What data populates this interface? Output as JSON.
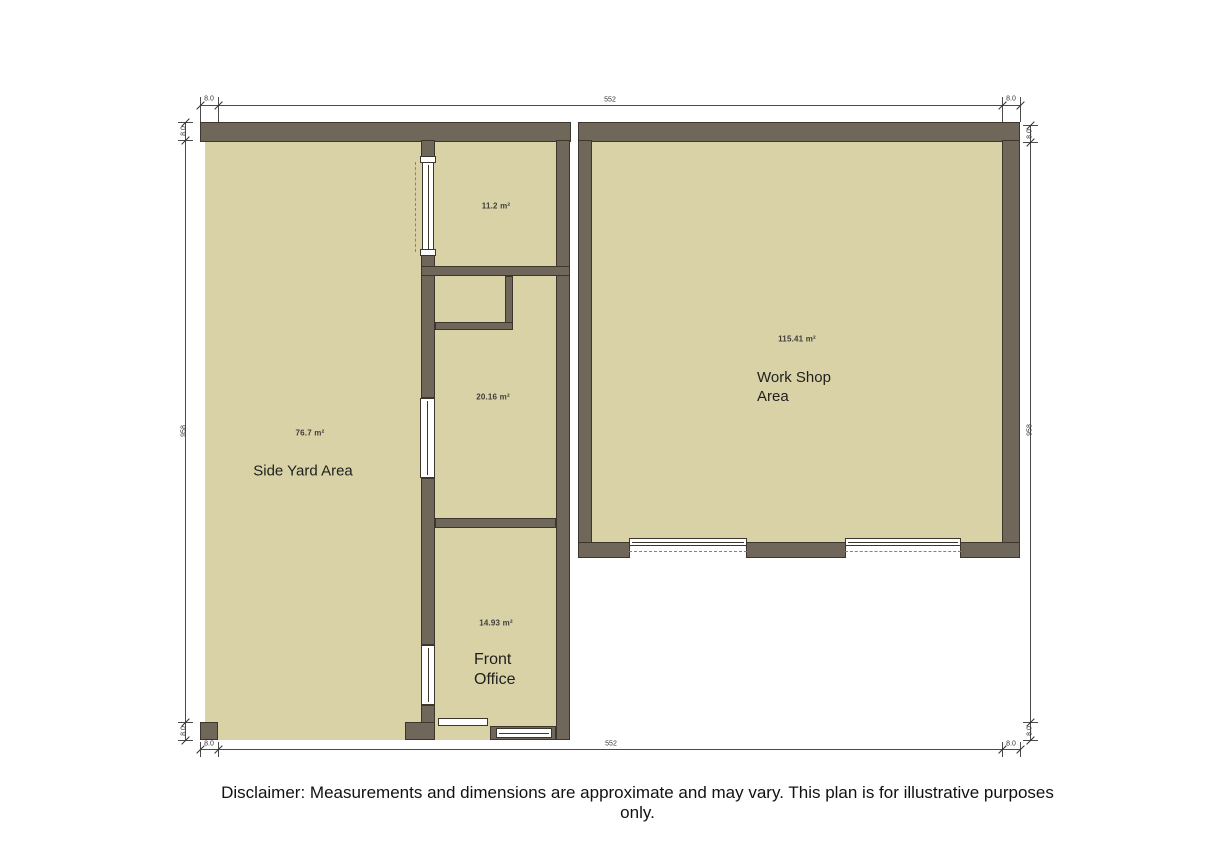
{
  "colors": {
    "background": "#ffffff",
    "floor": "#d8d2a6",
    "wall": "#6f6759",
    "wall_outline": "#3c362c",
    "dim_line": "#4a4a4a",
    "label": "#3d3d3d",
    "room_text": "#1f1f1f"
  },
  "rooms": {
    "side_yard": {
      "name": "Side Yard Area",
      "area": "76.7 m²"
    },
    "workshop": {
      "name_line1": "Work Shop",
      "name_line2": "Area",
      "area": "115.41 m²"
    },
    "front_office": {
      "name_line1": "Front",
      "name_line2": "Office",
      "area": "14.93 m²"
    },
    "store_top": {
      "area": "11.2 m²"
    },
    "store_middle": {
      "area": "20.16 m²"
    }
  },
  "dimensions": {
    "top": {
      "left_wall": "8.0",
      "span": "552",
      "right_wall": "8.0"
    },
    "bottom": {
      "left_wall": "8.0",
      "span": "552",
      "right_wall": "8.0"
    },
    "left": {
      "top_wall": "8.0",
      "span": "958",
      "bottom_wall": "8.0"
    },
    "right": {
      "top_wall": "8.0",
      "span": "958",
      "bottom_wall": "8.0"
    }
  },
  "disclaimer": "Disclaimer: Measurements and dimensions are approximate and may vary. This plan is for illustrative purposes only."
}
